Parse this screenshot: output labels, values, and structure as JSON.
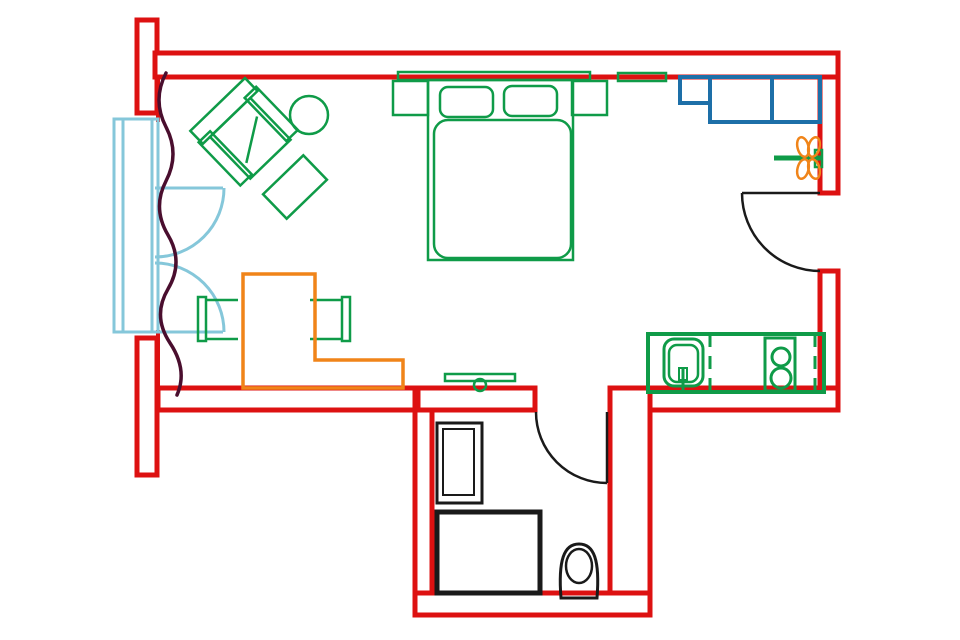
{
  "plan": {
    "type": "studio-apartment-floor-plan",
    "rooms": [
      "main-room",
      "bathroom",
      "kitchen-corner",
      "entry"
    ],
    "furniture": [
      "armchair",
      "side-table",
      "ottoman",
      "double-bed",
      "nightstand-left",
      "nightstand-right",
      "pillows",
      "duvet",
      "wall-shelf",
      "blue-cabinet",
      "radiator",
      "desk",
      "desk-chair-left",
      "desk-chair-right",
      "tv-shelf",
      "kitchen-counter",
      "sink",
      "stove",
      "washing-machine",
      "shower",
      "toilet",
      "window-french-doors",
      "curtain",
      "entry-door",
      "bathroom-door"
    ]
  },
  "colors": {
    "background": "#ffffff",
    "wall": "#dd1111",
    "furniture": "#0f9b48",
    "cabinet": "#1d6fa8",
    "window": "#85c7da",
    "curtain": "#4a0e2e",
    "desk": "#f08419",
    "radiator_coil": "#f08419",
    "fixture": "#1a1a1a"
  }
}
